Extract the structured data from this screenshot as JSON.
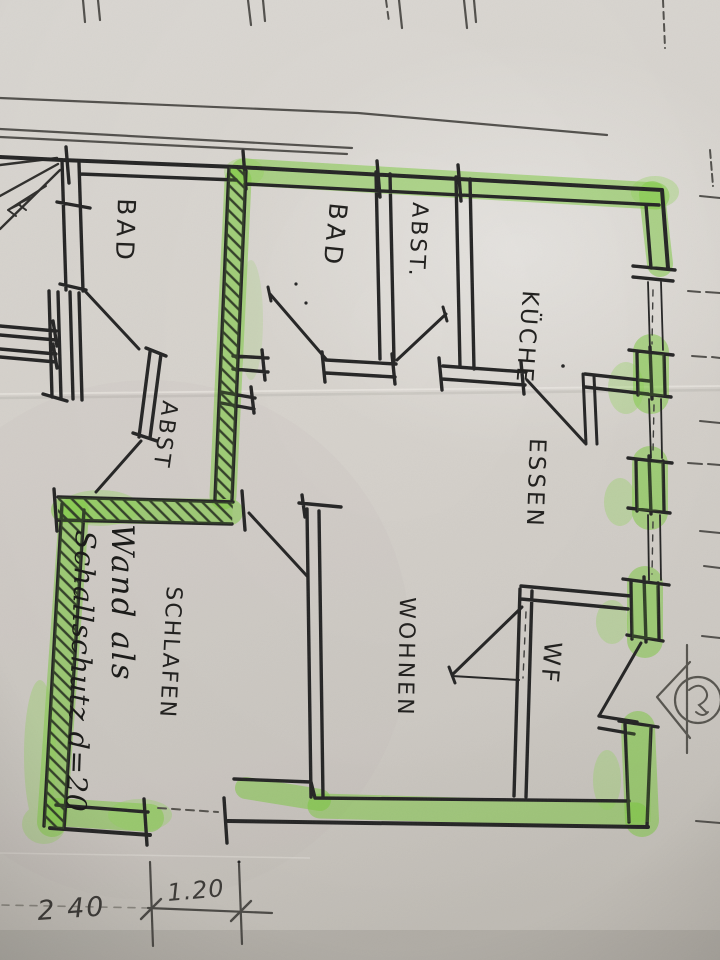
{
  "document": {
    "kind": "hand-drawn floor plan photo",
    "language": "de",
    "colors": {
      "paper": "#d6d2cc",
      "ink": "#242424",
      "pencil": "#55524d",
      "highlighter": "#79ca3a"
    },
    "rooms": [
      {
        "id": "bad-left",
        "label": "BAD"
      },
      {
        "id": "bad",
        "label": "BAD"
      },
      {
        "id": "abst-top",
        "label": "ABST."
      },
      {
        "id": "kueche",
        "label": "KÜCHE"
      },
      {
        "id": "essen",
        "label": "ESSEN"
      },
      {
        "id": "abst-hall",
        "label": "ABST"
      },
      {
        "id": "schlafen",
        "label": "SCHLAFEN"
      },
      {
        "id": "wohnen",
        "label": "WOHNEN"
      },
      {
        "id": "wf",
        "label": "WF"
      }
    ],
    "annotations": {
      "wall_note_line1": "Wand als",
      "wall_note_line2": "Schallschutz d=20"
    },
    "dimensions": {
      "wall_segment": "2 40",
      "opening": "1.20"
    }
  }
}
